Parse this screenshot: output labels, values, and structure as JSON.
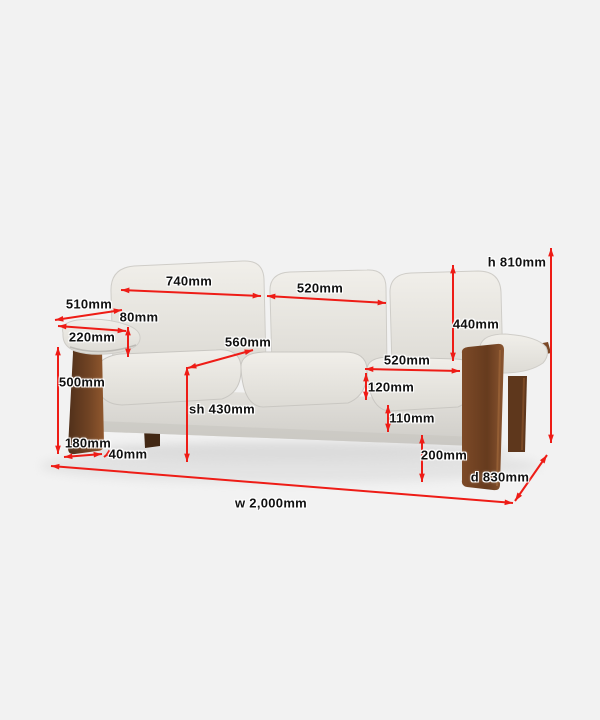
{
  "colors": {
    "background": "#f2f2f2",
    "dimension_line": "#ee1c16",
    "label_text": "#111111",
    "label_halo": "#ffffff",
    "fabric_light": "#f1efea",
    "fabric_shade": "#dddbd5",
    "wood_dark": "#50301a",
    "wood_light": "#90582e"
  },
  "diagram": {
    "subject": "three-seat fabric sofa with wooden side panels",
    "view": "front three-quarter dimension diagram",
    "unit": "mm",
    "dimensions": [
      {
        "id": "back-width-left",
        "text": "740mm",
        "value": 740,
        "unit": "mm"
      },
      {
        "id": "back-width-center",
        "text": "520mm",
        "value": 520,
        "unit": "mm"
      },
      {
        "id": "side-depth",
        "text": "510mm",
        "value": 510,
        "unit": "mm"
      },
      {
        "id": "arm-to-back-gap",
        "text": "80mm",
        "value": 80,
        "unit": "mm"
      },
      {
        "id": "armrest-width",
        "text": "220mm",
        "value": 220,
        "unit": "mm"
      },
      {
        "id": "seat-depth",
        "text": "560mm",
        "value": 560,
        "unit": "mm"
      },
      {
        "id": "side-panel-height",
        "text": "500mm",
        "value": 500,
        "unit": "mm"
      },
      {
        "id": "seat-height",
        "text": "sh 430mm",
        "value": 430,
        "unit": "mm",
        "prefix": "sh"
      },
      {
        "id": "leg-base-width",
        "text": "180mm",
        "value": 180,
        "unit": "mm"
      },
      {
        "id": "panel-thickness",
        "text": "40mm",
        "value": 40,
        "unit": "mm"
      },
      {
        "id": "overall-height",
        "text": "h 810mm",
        "value": 810,
        "unit": "mm",
        "prefix": "h"
      },
      {
        "id": "backrest-height",
        "text": "440mm",
        "value": 440,
        "unit": "mm"
      },
      {
        "id": "seat-cushion-width",
        "text": "520mm",
        "value": 520,
        "unit": "mm"
      },
      {
        "id": "seat-cushion-thickness",
        "text": "120mm",
        "value": 120,
        "unit": "mm"
      },
      {
        "id": "seat-frame-height",
        "text": "110mm",
        "value": 110,
        "unit": "mm"
      },
      {
        "id": "under-seat-clearance",
        "text": "200mm",
        "value": 200,
        "unit": "mm"
      },
      {
        "id": "overall-depth",
        "text": "d 830mm",
        "value": 830,
        "unit": "mm",
        "prefix": "d"
      },
      {
        "id": "overall-width",
        "text": "w 2,000mm",
        "value": 2000,
        "unit": "mm",
        "prefix": "w"
      }
    ]
  }
}
